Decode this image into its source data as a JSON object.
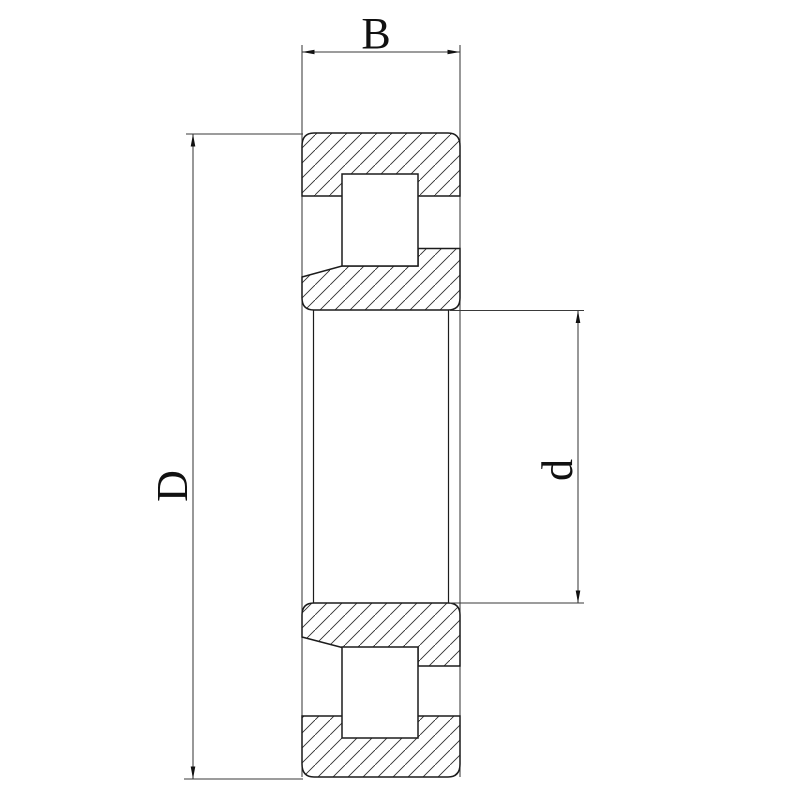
{
  "labels": {
    "width": "B",
    "outer_diameter": "D",
    "bore_diameter": "d"
  },
  "colors": {
    "line": "#1c1c1c",
    "dimension_line": "#3a3a3a",
    "hatch": "#2e2e2e",
    "background": "#ffffff"
  }
}
